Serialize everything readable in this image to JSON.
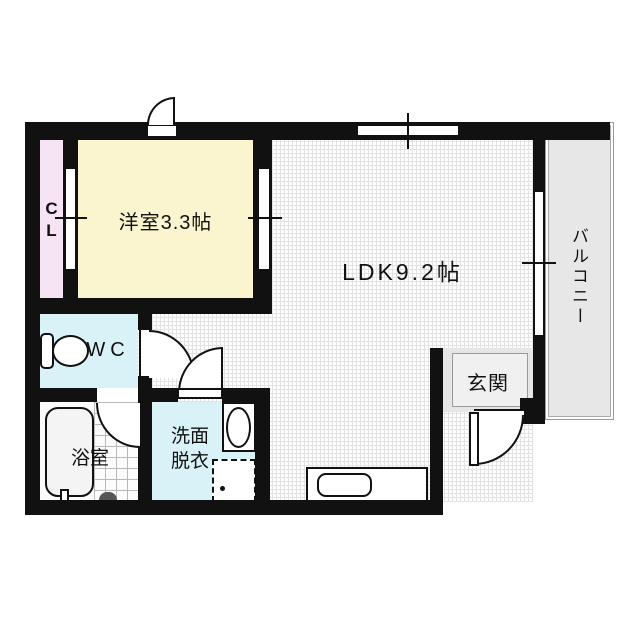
{
  "plan": {
    "type": "floor-plan",
    "rooms": {
      "western_room": {
        "label": "洋室3.3帖",
        "color": "#faf5cf"
      },
      "ldk": {
        "label": "LDK9.2帖",
        "color": "#ffffff"
      },
      "closet": {
        "label_line1": "C",
        "label_line2": "L",
        "color": "#f6e3f4"
      },
      "wc": {
        "label": "WC",
        "color": "#d8f2f7"
      },
      "bath": {
        "label": "浴室",
        "color": "#fbfbfb"
      },
      "washroom": {
        "label_line1": "洗面",
        "label_line2": "脱衣",
        "color": "#d8f2f7"
      },
      "entrance": {
        "label": "玄関",
        "color": "#e6e6e6"
      },
      "balcony": {
        "label": "バルコニー",
        "color": "#e7e7e7"
      }
    },
    "colors": {
      "wall": "#111111",
      "text": "#111111"
    }
  }
}
